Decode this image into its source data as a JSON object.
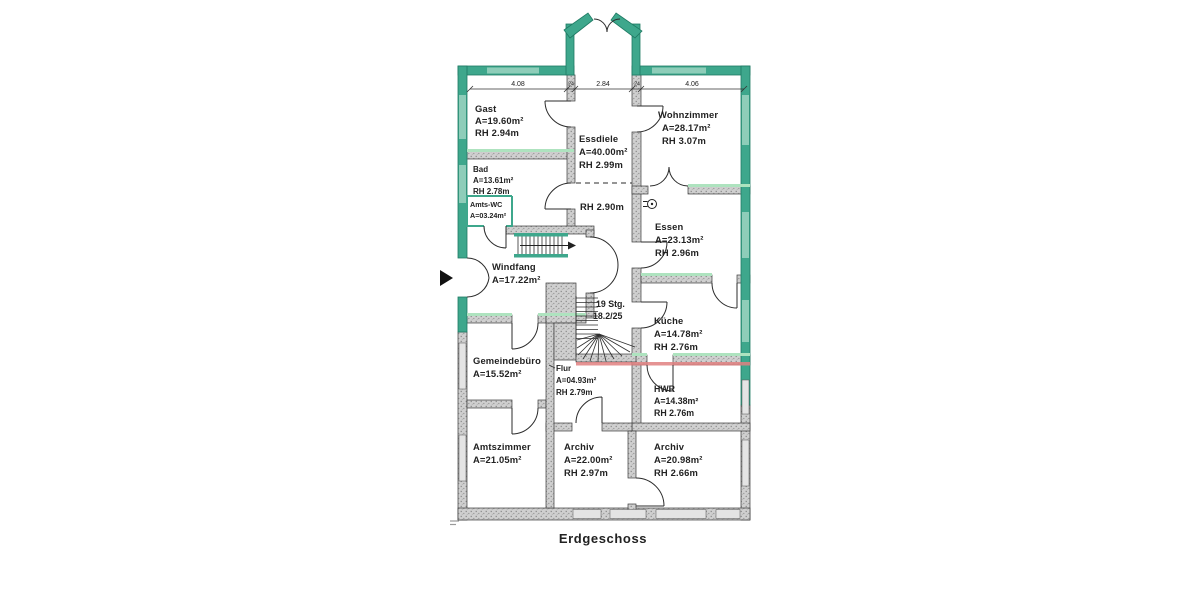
{
  "title": "Erdgeschoss",
  "dimensions": {
    "seg1": "4.08",
    "wall1": "24",
    "seg2": "2.84",
    "wall2": "24",
    "seg3": "4.06"
  },
  "stairs": {
    "count": "19 Stg.",
    "ratio": "18.2/25"
  },
  "hall_note": "RH 2.90m",
  "rooms": {
    "gast": {
      "name": "Gast",
      "area": "A=19.60m²",
      "height": "RH 2.94m"
    },
    "essdiele": {
      "name": "Essdiele",
      "area": "A=40.00m²",
      "height": "RH 2.99m"
    },
    "wohnzimmer": {
      "name": "Wohnzimmer",
      "area": "A=28.17m²",
      "height": "RH 3.07m"
    },
    "bad": {
      "name": "Bad",
      "area": "A=13.61m²",
      "height": "RH 2.78m"
    },
    "amts_wc": {
      "name": "Amts-WC",
      "area": "A=03.24m²"
    },
    "essen": {
      "name": "Essen",
      "area": "A=23.13m²",
      "height": "RH 2.96m"
    },
    "windfang": {
      "name": "Windfang",
      "area": "A=17.22m²"
    },
    "kueche": {
      "name": "Küche",
      "area": "A=14.78m²",
      "height": "RH 2.76m"
    },
    "gemeindebuero": {
      "name": "Gemeindebüro",
      "area": "A=15.52m²"
    },
    "flur": {
      "name": "Flur",
      "area": "A=04.93m²",
      "height": "RH 2.79m"
    },
    "hwr": {
      "name": "HWR",
      "area": "A=14.38m²",
      "height": "RH 2.76m"
    },
    "amtszimmer": {
      "name": "Amtszimmer",
      "area": "A=21.05m²"
    },
    "archiv1": {
      "name": "Archiv",
      "area": "A=22.00m²",
      "height": "RH 2.97m"
    },
    "archiv2": {
      "name": "Archiv",
      "area": "A=20.98m²",
      "height": "RH 2.66m"
    }
  },
  "colors": {
    "exterior_wall": "#3EA78C",
    "exterior_wall_light": "#8ECDB9",
    "highlight_green": "#AEE3BF",
    "highlight_red": "#E08080"
  }
}
